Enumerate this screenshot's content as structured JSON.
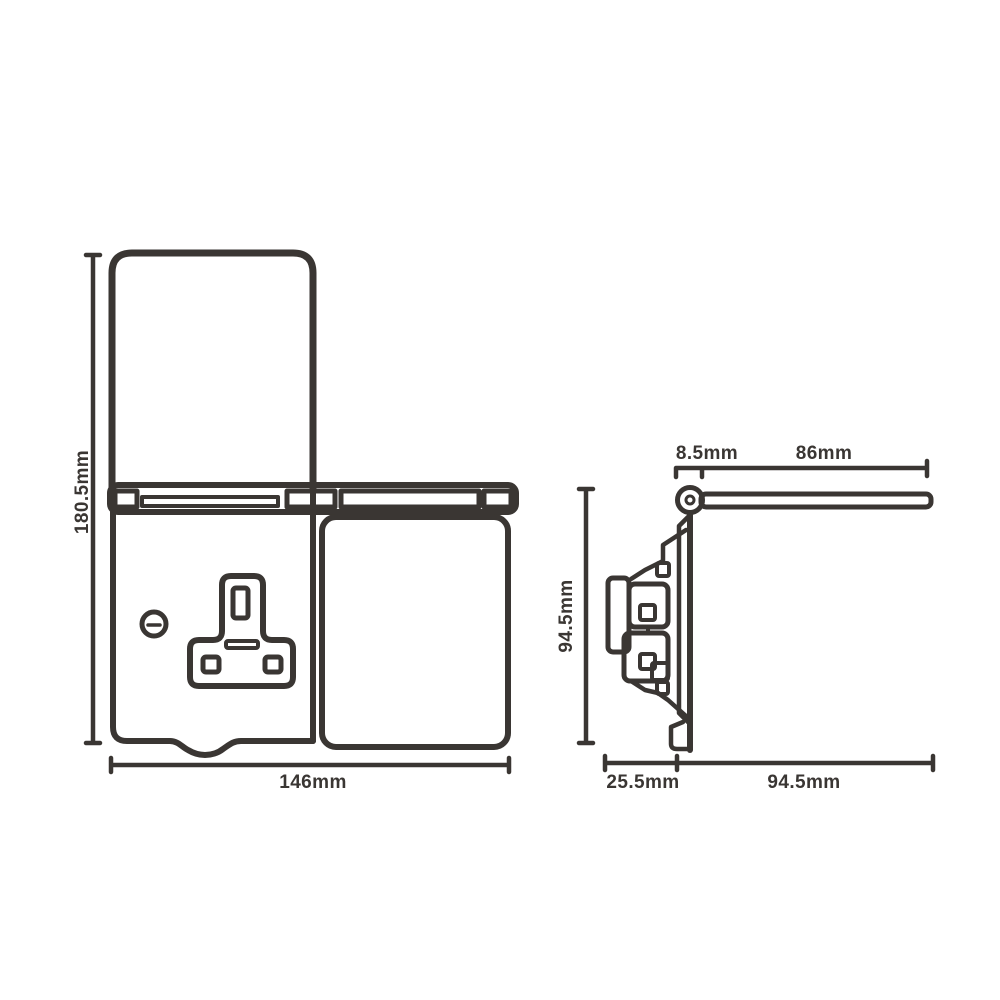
{
  "drawing": {
    "line_color": "#3a3633",
    "background_color": "#ffffff",
    "front_view": {
      "overall_height": "180.5mm",
      "overall_width": "146mm"
    },
    "side_view": {
      "plate_height": "94.5mm",
      "hinge_offset": "8.5mm",
      "lid_length": "86mm",
      "box_depth": "25.5mm",
      "open_lid_projection": "94.5mm"
    }
  }
}
